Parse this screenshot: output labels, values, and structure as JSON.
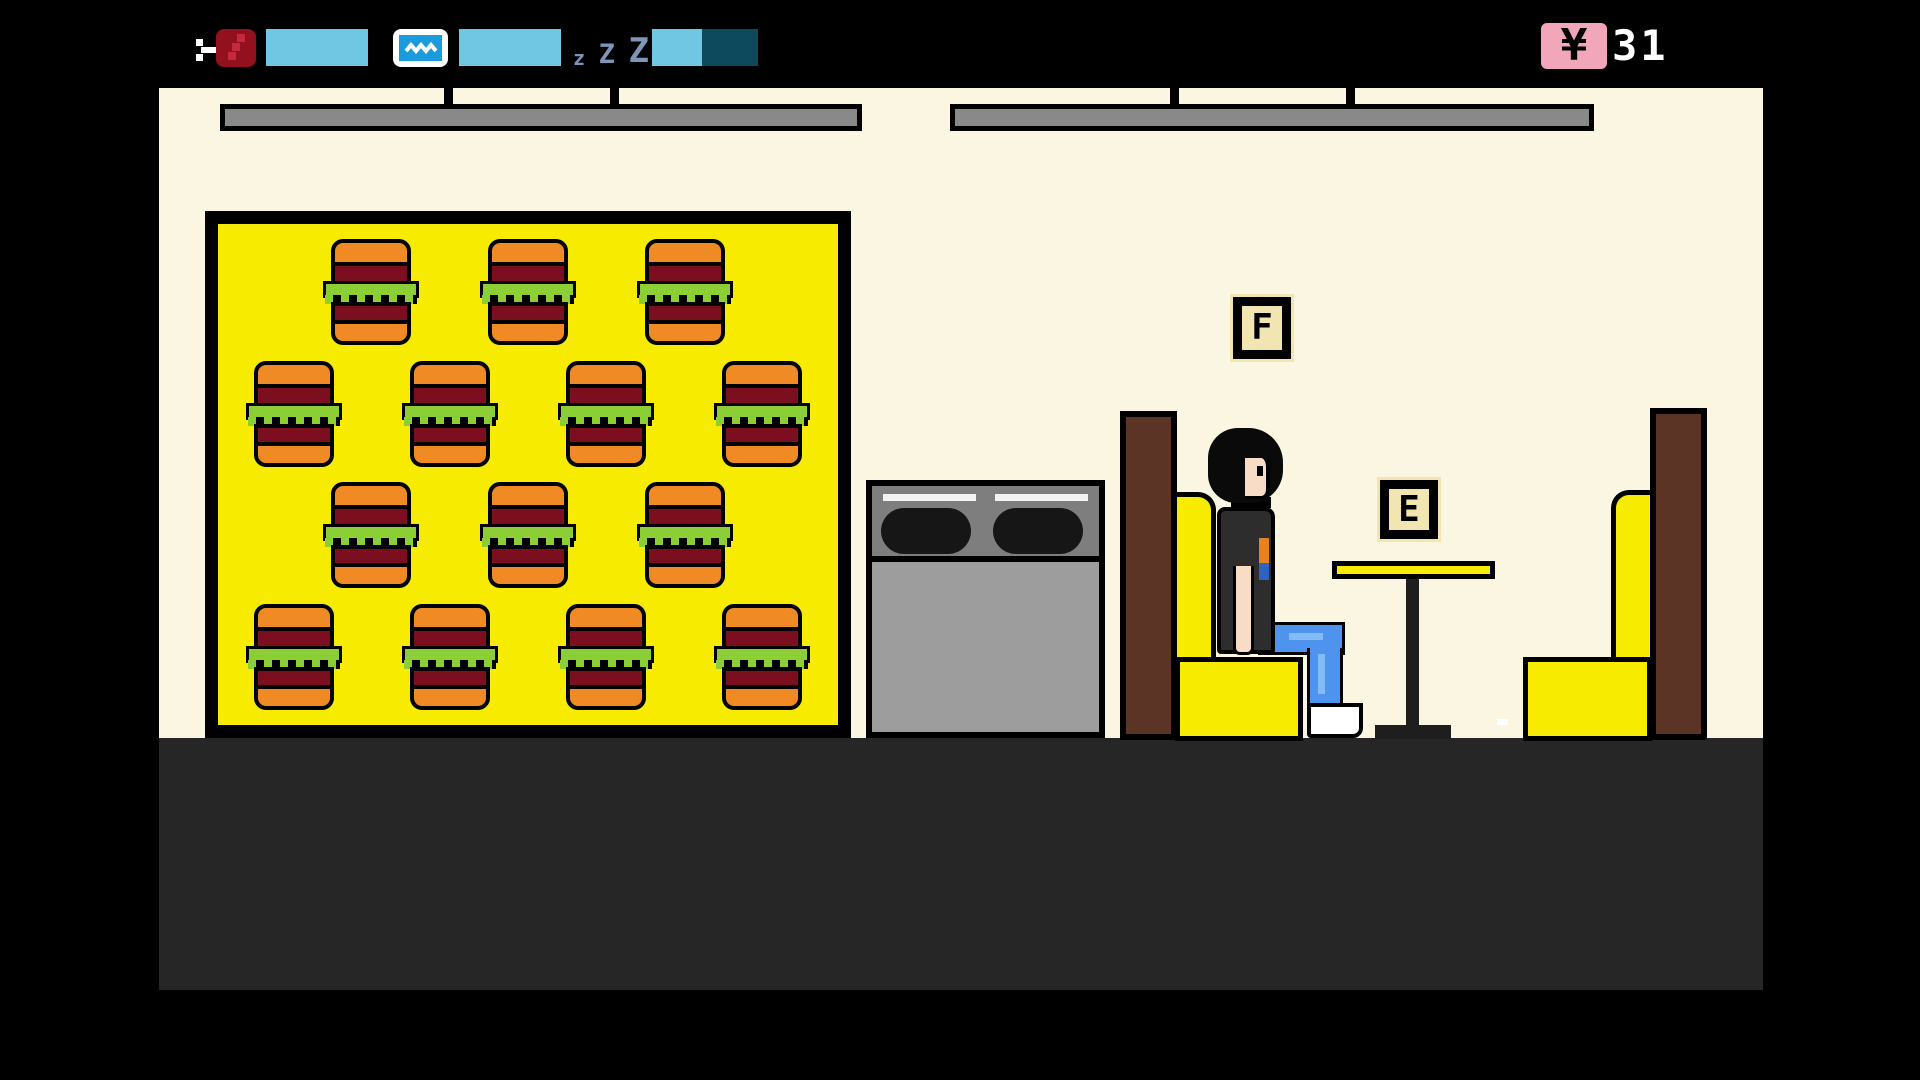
{
  "colors": {
    "cream": "#FAF6E1",
    "yellow": "#F7EB00",
    "floor": "#262626",
    "booth_brown": "#5B3425",
    "light_gray": "#898989",
    "stove_top": "#7E7E7E",
    "stove_body": "#9D9D9D",
    "bun_orange": "#F08A25",
    "patty_red": "#7C0F1F",
    "lettuce_green": "#8BCE35",
    "skin": "#F8DCC6",
    "shirt": "#2D2D2D",
    "jeans_blue": "#4E93EE",
    "jeans_hl": "#83BBF8",
    "bar_fill": "#6FC7E3",
    "bar_empty": "#0D4A5E",
    "hunger_red": "#93101E",
    "hunger_dot": "#C4293C",
    "tv_blue": "#1C9BDC",
    "zzz_slate": "#7E95B8",
    "money_pink": "#F1A6BA",
    "prompt_cream": "#F1E6B2"
  },
  "hud": {
    "meters": [
      {
        "id": "hunger",
        "icon": "meat-icon",
        "fill_percent": 100
      },
      {
        "id": "fun",
        "icon": "tv-icon",
        "fill_percent": 100
      },
      {
        "id": "sleep",
        "icon": "zzz-icon",
        "fill_percent": 47
      }
    ],
    "sleep_glyph": {
      "small": "z",
      "mid": "Z",
      "large": "Z"
    },
    "money": {
      "symbol": "¥",
      "value": "31"
    }
  },
  "scene": {
    "prompts": {
      "f": "F",
      "e": "E"
    },
    "menu_board": {
      "rows": [
        3,
        4,
        3,
        4
      ],
      "item": "burger"
    }
  }
}
